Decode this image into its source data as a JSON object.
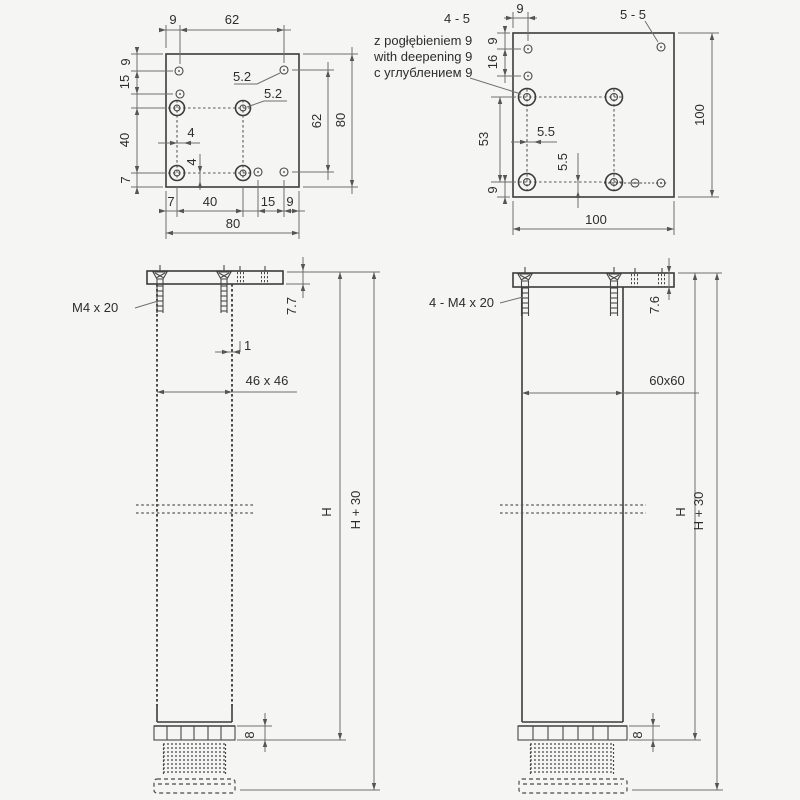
{
  "drawing": {
    "accent_line_color": "#3c3c3c",
    "dim_line_color": "#6f6f6f",
    "plate80": {
      "top9": "9",
      "top62": "62",
      "left9": "9",
      "left15": "15",
      "left40": "40",
      "left7": "7",
      "right62": "62",
      "right80": "80",
      "bot7": "7",
      "bot40": "40",
      "bot15": "15",
      "bot9": "9",
      "bot80": "80",
      "hole1": "5.2",
      "hole2": "5.2",
      "off_h": "4",
      "off_v": "4"
    },
    "plate100": {
      "callout": "4 - 5",
      "note_pl": "z pogłębieniem 9",
      "note_en": "with deepening 9",
      "note_ru": "с углублением 9",
      "corner": "5 - 5",
      "top9": "9",
      "left9a": "9",
      "left16": "16",
      "left53": "53",
      "left9b": "9",
      "right100": "100",
      "bot100": "100",
      "off_h": "5.5",
      "off_v": "5.5"
    },
    "leg46": {
      "screw": "M4 x 20",
      "thk": "7.7",
      "wall": "1",
      "section": "46 x 46",
      "h": "H",
      "h30": "H + 30",
      "foot": "8"
    },
    "leg60": {
      "screw": "4 - M4 x 20",
      "thk": "7.6",
      "section": "60x60",
      "h": "H",
      "h30": "H + 30",
      "foot": "8"
    }
  }
}
